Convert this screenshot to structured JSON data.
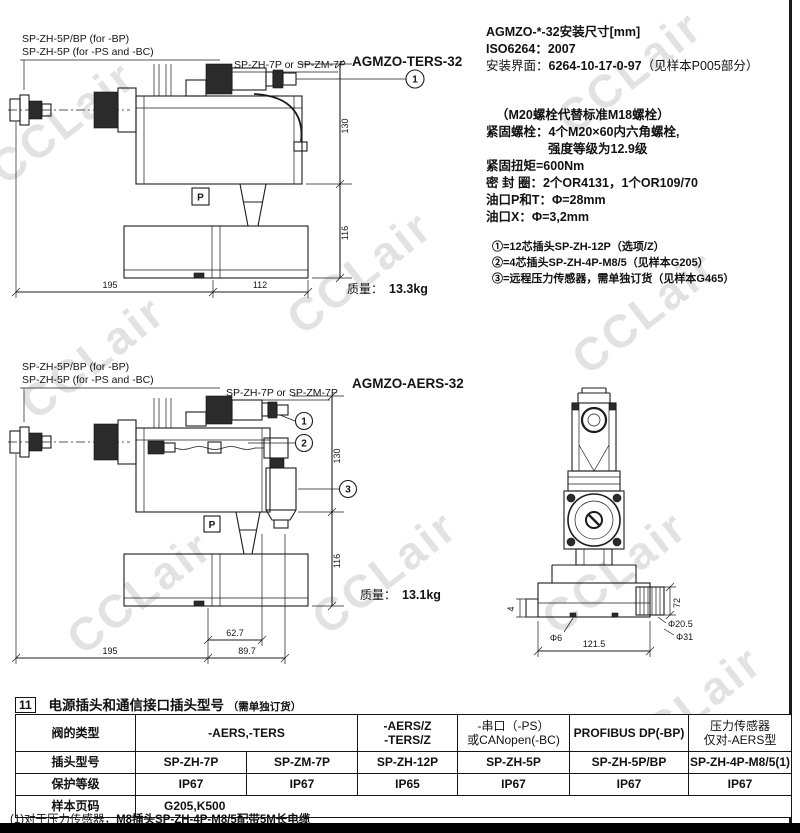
{
  "page": {
    "watermark": "CCLair"
  },
  "drawing1": {
    "title": "AGMZO-TERS-32",
    "label_plug_bp": "SP-ZH-5P/BP (for -BP)",
    "label_plug_ps": "SP-ZH-5P (for -PS and -BC)",
    "label_plug_7p": "SP-ZH-7P or SP-ZM-7P",
    "callout_1": "1",
    "dim_width_left": "195",
    "dim_width_right": "112",
    "dim_height_top": "130",
    "dim_height_bottom": "116",
    "port_label": "P",
    "mass_label": "质量：",
    "mass_value": "13.3kg"
  },
  "specs": {
    "title_line": "AGMZO-*-32安装尺寸[mm]",
    "iso_line": "ISO6264：2007",
    "interface_label": "安装界面：",
    "interface_value": "6264-10-17-0-97",
    "interface_note": "（见样本P005部分）",
    "bolt_note": "（M20螺栓代替标准M18螺栓）",
    "bolt_line1": "紧固螺栓：4个M20×60内六角螺栓,",
    "bolt_line2": "强度等级为12.9级",
    "torque_line": "紧固扭矩=600Nm",
    "seal_line": "密 封 圈：2个OR4131，1个OR109/70",
    "port_pt_line": "油口P和T：Φ=28mm",
    "port_x_line": "油口X：Φ=3,2mm",
    "note1": "①=12芯插头SP-ZH-12P（选项/Z）",
    "note2": "②=4芯插头SP-ZH-4P-M8/5（见样本G205）",
    "note3": "③=远程压力传感器，需单独订货（见样本G465）"
  },
  "drawing2": {
    "title": "AGMZO-AERS-32",
    "label_plug_bp": "SP-ZH-5P/BP (for -BP)",
    "label_plug_ps": "SP-ZH-5P (for -PS and -BC)",
    "label_plug_7p": "SP-ZH-7P or SP-ZM-7P",
    "callout_1": "1",
    "callout_2": "2",
    "callout_3": "3",
    "dim_62": "62.7",
    "dim_width_left": "195",
    "dim_width_right": "89.7",
    "dim_height_top": "130",
    "dim_height_bottom": "116",
    "port_label": "P",
    "mass_label": "质量：",
    "mass_value": "13.1kg"
  },
  "drawing3": {
    "dim_4": "4",
    "dim_phi6": "Φ6",
    "dim_phi205": "Φ20.5",
    "dim_phi31": "Φ31",
    "dim_72": "72",
    "dim_1215": "121.5"
  },
  "plug_table": {
    "section_no": "11",
    "section_title": "电源插头和通信接口插头型号",
    "section_note": "（需单独订货）",
    "col_type": "阀的类型",
    "col_aers_ters": "-AERS,-TERS",
    "col_z_line1": "-AERS/Z",
    "col_z_line2": "-TERS/Z",
    "col_serial_line1": "-串口（-PS）",
    "col_serial_line2": "或CANopen(-BC)",
    "col_profibus": "PROFIBUS DP(-BP)",
    "col_sensor_line1": "压力传感器",
    "col_sensor_line2": "仅对-AERS型",
    "row_plug_label": "插头型号",
    "plug_values": [
      "SP-ZH-7P",
      "SP-ZM-7P",
      "SP-ZH-12P",
      "SP-ZH-5P",
      "SP-ZH-5P/BP",
      "SP-ZH-4P-M8/5(1)"
    ],
    "row_ip_label": "保护等级",
    "ip_values": [
      "IP67",
      "IP67",
      "IP65",
      "IP67",
      "IP67",
      "IP67"
    ],
    "row_page_label": "样本页码",
    "page_value": "G205,K500",
    "footnote_prefix": "(1)对于压力传感器，",
    "footnote_bold": "M8插头SP-ZH-4P-M8/5配带5M长电缆"
  }
}
